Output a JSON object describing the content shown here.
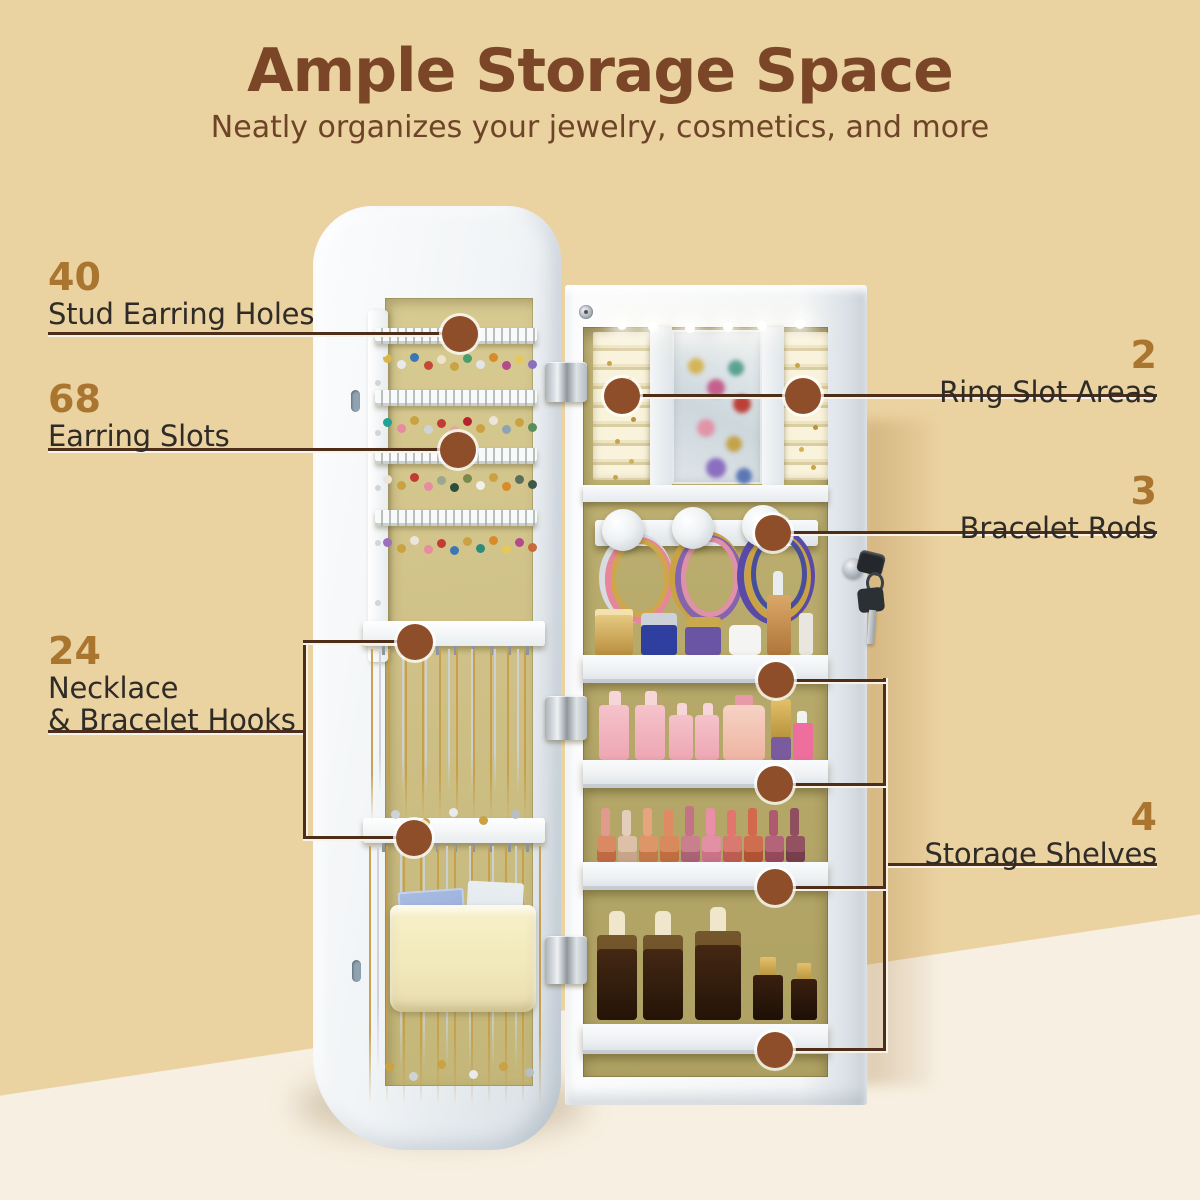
{
  "header": {
    "title": "Ample Storage Space",
    "subtitle": "Neatly organizes your jewelry, cosmetics, and more"
  },
  "callouts": {
    "stud_earring_holes": {
      "number": "40",
      "label": "Stud Earring Holes"
    },
    "earring_slots": {
      "number": "68",
      "label": "Earring Slots"
    },
    "necklace_hooks": {
      "number": "24",
      "label_line1": "Necklace",
      "label_line2": "& Bracelet Hooks"
    },
    "ring_slot_areas": {
      "number": "2",
      "label": "Ring Slot Areas"
    },
    "bracelet_rods": {
      "number": "3",
      "label": "Bracelet Rods"
    },
    "storage_shelves": {
      "number": "4",
      "label": "Storage Shelves"
    }
  },
  "colors": {
    "background_top": "#ebd2a1",
    "background_bottom": "#f7efe1",
    "title_brown": "#7a4627",
    "number_gold": "#a9752f",
    "label_dark": "#2f2b27",
    "leader_line": "#4e2e18",
    "callout_dot": "#8f4e2a",
    "cabinet_white": "#f4f6f8",
    "interior_khaki": "#b7aa6b"
  }
}
